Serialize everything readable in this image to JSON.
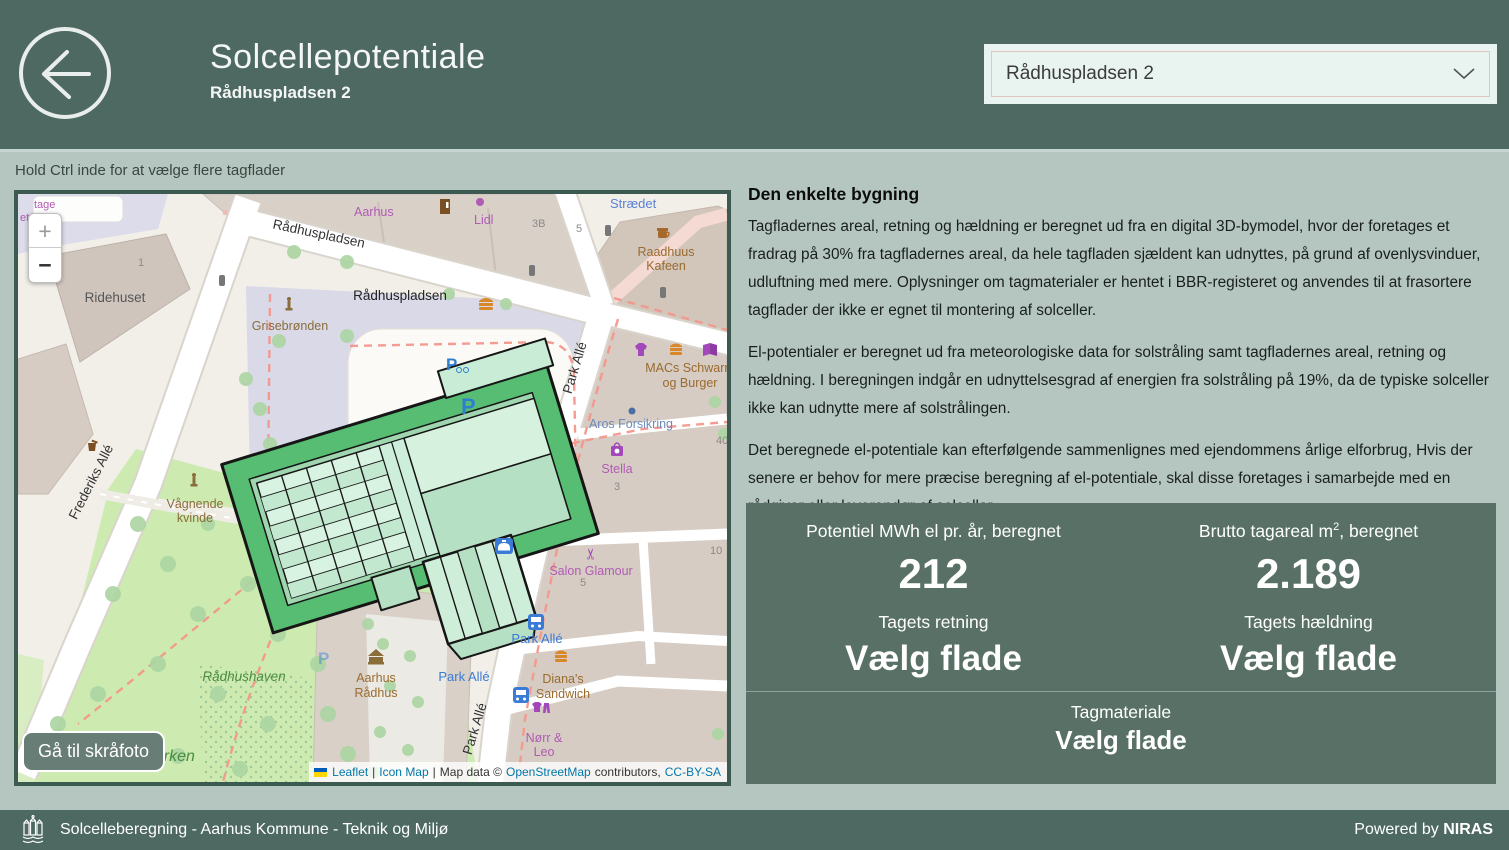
{
  "theme": {
    "header_bg": "#4d6961",
    "page_bg": "#b5c6c0",
    "stats_bg": "#587065",
    "map_border": "#3d5a52",
    "link_color": "#3a66c4",
    "attribution_link": "#0078a8",
    "selected_roof_green": "#57bd72"
  },
  "header": {
    "title": "Solcellepotentiale",
    "subtitle": "Rådhuspladsen 2",
    "dropdown_value": "Rådhuspladsen 2"
  },
  "icons": {
    "back": "arrow-left-circle-icon",
    "dropdown": "chevron-down-icon",
    "zoom_in": "plus-icon",
    "zoom_out": "minus-icon"
  },
  "map_hint": "Hold Ctrl inde for at vælge flere tagflader",
  "map": {
    "zoom_in": "+",
    "zoom_out": "−",
    "skrafoto_button": "Gå til skråfoto",
    "attribution": {
      "leaflet": "Leaflet",
      "sep1": "|",
      "icon_map": "Icon Map",
      "sep2": "|",
      "map_data": "Map data ©",
      "osm": "OpenStreetMap",
      "contributors": "contributors,",
      "license": "CC-BY-SA"
    },
    "labels": {
      "tage": "tage",
      "etariat": "etariat",
      "aarhus": "Aarhus",
      "lidl": "Lidl",
      "num_3b": "3B",
      "num_5a": "5",
      "straedet": "Strædet",
      "raadhuus_1": "Raadhuus",
      "raadhuus_2": "Kafeen",
      "rdp_street": "Rådhuspladsen",
      "rdp_plaza": "Rådhuspladsen",
      "grisebroenden": "Grisebrønden",
      "ridehuset": "Ridehuset",
      "num_1": "1",
      "macs_1": "MACs Schwarm",
      "macs_2": "og Burger",
      "aros": "Aros Forsikring",
      "stella": "Stella",
      "num_3": "3",
      "num_40": "40",
      "num_10": "10",
      "num_5c": "5",
      "frederiks_alle": "Frederiks Allé",
      "vaagnende_1": "Vågnende",
      "vaagnende_2": "kvinde",
      "park_alle_street_1": "Park Allé",
      "park_alle_street_2": "Park Allé",
      "park_alle_stop_1": "Park Allé",
      "park_alle_stop_2": "Park Allé",
      "p_bike": "P",
      "p_plaza": "P",
      "p_faint": "P",
      "salon_glamour": "Salon Glamour",
      "aarhus_raadhus_1": "Aarhus",
      "aarhus_raadhus_2": "Rådhus",
      "dianas_1": "Diana's",
      "dianas_2": "Sandwich",
      "noerr_1": "Nørr &",
      "noerr_2": "Leo",
      "raadhushaven": "Rådhushaven",
      "sparken": "sparken"
    }
  },
  "info": {
    "heading": "Den enkelte bygning",
    "paragraphs": [
      "Tagfladernes areal, retning og hældning er beregnet ud fra en digital 3D-bymodel, hvor der foretages et fradrag på 30% fra tagfladernes areal, da hele tagfladen sjældent kan udnyttes, på grund af ovenlysvinduer, udluftning med mere. Oplysninger om tagmaterialer er hentet i BBR-registeret og anvendes til at frasortere tagflader der ikke er egnet til montering af solceller.",
      "El-potentialer er beregnet ud fra meteorologiske data for solstråling samt tagfladernes areal, retning og hældning. I beregningen indgår en udnyttelsesgrad af energien fra solstråling på 19%, da de typiske solceller ikke kan udnytte mere af solstrålingen.",
      "Det beregnede el-potentiale kan efterfølgende sammenlignes med ejendommens årlige elforbrug, Hvis der senere er behov for mere præcise beregning af el-potentiale, skal disse foretages i samarbejde med en rådgiver eller leverandør af solceller."
    ],
    "p4_before": "Hvis du til vide mere om baggrund, regnemetoder og hvordan du kan søge om tilladelse eller tilskud, kan du læse mere på ",
    "p4_link": "GISPortalen",
    "p4_after": "."
  },
  "stats": {
    "potential": {
      "label": "Potentiel MWh el pr. år, beregnet",
      "value": "212"
    },
    "area": {
      "label_pre": "Brutto tagareal m",
      "label_sup": "2",
      "label_post": ", beregnet",
      "value": "2.189"
    },
    "direction": {
      "label": "Tagets retning",
      "value": "Vælg flade"
    },
    "slope": {
      "label": "Tagets hældning",
      "value": "Vælg flade"
    },
    "material": {
      "label": "Tagmateriale",
      "value": "Vælg flade"
    }
  },
  "footer": {
    "left": "Solcelleberegning - Aarhus Kommune - Teknik og Miljø",
    "powered_by": "Powered by ",
    "brand": "NIRAS"
  }
}
